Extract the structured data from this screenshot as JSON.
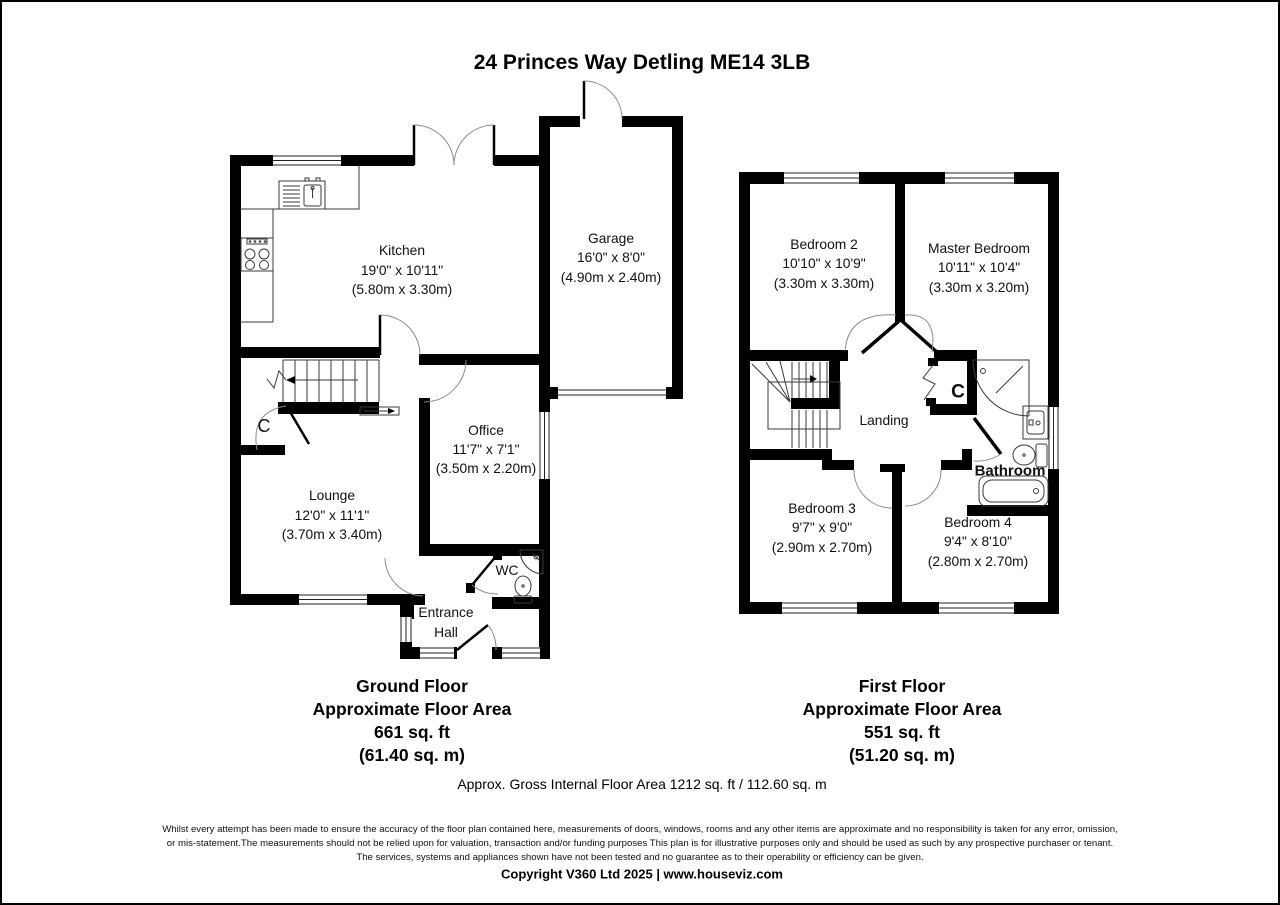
{
  "title": "24 Princes Way Detling ME14 3LB",
  "colors": {
    "wall": "#000000",
    "background": "#ffffff"
  },
  "ground_floor": {
    "rooms": {
      "kitchen": {
        "name": "Kitchen",
        "imperial": "19'0\" x 10'11\"",
        "metric": "(5.80m x 3.30m)"
      },
      "garage": {
        "name": "Garage",
        "imperial": "16'0\" x 8'0\"",
        "metric": "(4.90m x 2.40m)"
      },
      "office": {
        "name": "Office",
        "imperial": "11'7\" x 7'1\"",
        "metric": "(3.50m x 2.20m)"
      },
      "lounge": {
        "name": "Lounge",
        "imperial": "12'0\" x 11'1\"",
        "metric": "(3.70m x 3.40m)"
      },
      "wc": {
        "name": "WC"
      },
      "entrance_hall": {
        "line1": "Entrance",
        "line2": "Hall"
      },
      "cupboard": {
        "name": "C"
      }
    },
    "summary": {
      "floor": "Ground Floor",
      "area_label": "Approximate Floor Area",
      "area_ft": "661 sq. ft",
      "area_m": "(61.40 sq. m)"
    }
  },
  "first_floor": {
    "rooms": {
      "bedroom2": {
        "name": "Bedroom 2",
        "imperial": "10'10\" x 10'9\"",
        "metric": "(3.30m x 3.30m)"
      },
      "master": {
        "name": "Master Bedroom",
        "imperial": "10'11\" x 10'4\"",
        "metric": "(3.30m x 3.20m)"
      },
      "bedroom3": {
        "name": "Bedroom 3",
        "imperial": "9'7\" x 9'0\"",
        "metric": "(2.90m x 2.70m)"
      },
      "bedroom4": {
        "name": "Bedroom 4",
        "imperial": "9'4\" x 8'10\"",
        "metric": "(2.80m x 2.70m)"
      },
      "landing": {
        "name": "Landing"
      },
      "bathroom": {
        "name": "Bathroom"
      },
      "cupboard": {
        "name": "C"
      }
    },
    "summary": {
      "floor": "First Floor",
      "area_label": "Approximate Floor Area",
      "area_ft": "551 sq. ft",
      "area_m": "(51.20 sq. m)"
    }
  },
  "totals": {
    "gross_area": "Approx. Gross Internal Floor Area 1212 sq. ft / 112.60 sq. m"
  },
  "disclaimer": {
    "line1": "Whilst every attempt has been made to ensure the accuracy of the floor plan contained here, measurements of doors, windows, rooms and any other items are approximate and no responsibility is taken for any error, omission,",
    "line2": "or mis-statement.The measurements should not be relied upon for valuation, transaction and/or funding purposes This plan is for illustrative purposes only and should be used as such by any prospective purchaser or tenant.",
    "line3": "The services, systems and appliances shown have not been tested and no guarantee as to their operability or efficiency can be given."
  },
  "copyright": "Copyright V360 Ltd 2025 | www.houseviz.com"
}
